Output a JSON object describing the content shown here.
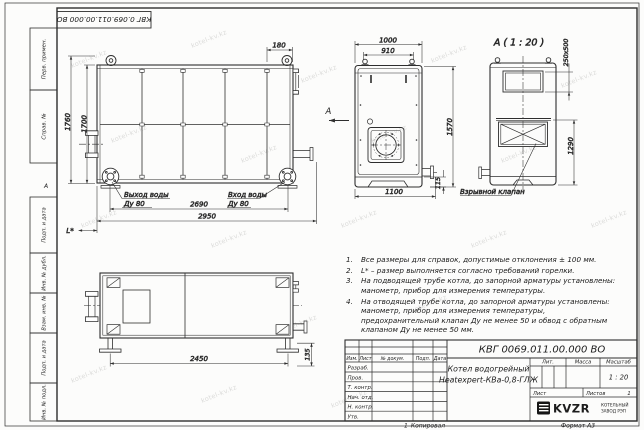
{
  "frame": {
    "stamp": "КВГ 0.069.011.00.000 ВО",
    "col1": "Перв. примен.",
    "col2": "Справ. №",
    "col3": "Подп. и дата",
    "col4": "Инв. № дубл.",
    "col5": "Взам. инв. №",
    "col6": "Подп. и дата",
    "col7": "Инв. № подл.",
    "zone_a": "А",
    "zone_1": "1",
    "copy": "Копировал",
    "format": "Формат А3"
  },
  "watermark": {
    "text": "kotel-kv.kz"
  },
  "views": {
    "side": {
      "dim_h1": "1760",
      "dim_h2": "1700",
      "dim_180": "180",
      "dim_2690": "2690",
      "dim_2950": "2950",
      "dim_l": "L*",
      "out1": "Выход воды",
      "out2": "Ду 80",
      "in1": "Вход воды",
      "in2": "Ду 80"
    },
    "front": {
      "dim_1000": "1000",
      "dim_910": "910",
      "dim_1570": "1570",
      "dim_1100": "1100",
      "dim_115": "115",
      "arrow": "A"
    },
    "rear": {
      "title": "А ( 1 : 20 )",
      "dim_valve": "250х500",
      "dim_1290": "1290",
      "valve": "Взрывной клапан"
    },
    "plan": {
      "dim_2450": "2450",
      "dim_135": "135"
    }
  },
  "notes": {
    "items": [
      {
        "n": "1.",
        "t": "Все размеры для справок, допустимые отклонения ± 100 мм."
      },
      {
        "n": "2.",
        "t": "L* – размер выполняется согласно требований горелки."
      },
      {
        "n": "3.",
        "t": "На подводящей трубе котла, до запорной арматуры установлены: манометр, прибор для измерения температуры."
      },
      {
        "n": "4.",
        "t": "На отводящей трубе котла, до запорной арматуры установлены: манометр, прибор для измерения температуры, предохранительный клапан Ду не менее 50 и обвод с обратным клапаном Ду не менее 50 мм."
      }
    ]
  },
  "tb": {
    "designation": "КВГ 0069.011.00.000 ВО",
    "name1": "Котел водогрейный",
    "name2": "Heatexpert-КВа-0,8-ГЛЖ",
    "h_izm": "Изм.",
    "h_list": "Лист",
    "h_doc": "№ докум.",
    "h_sign": "Подп.",
    "h_date": "Дата",
    "r1": "Разраб.",
    "r2": "Пров.",
    "r3": "Т. контр.",
    "r4": "Нач. отд.",
    "r5": "Н. контр.",
    "r6": "Утв.",
    "lit": "Лит.",
    "mass": "Масса",
    "scale_l": "Масштаб",
    "scale": "1 : 20",
    "sheet": "Лист",
    "sheets": "Листов",
    "sheets_n": "1",
    "logo": "KVZR",
    "co1": "КОТЕЛЬНЫЙ",
    "co2": "ЗАВОД РЭП"
  }
}
